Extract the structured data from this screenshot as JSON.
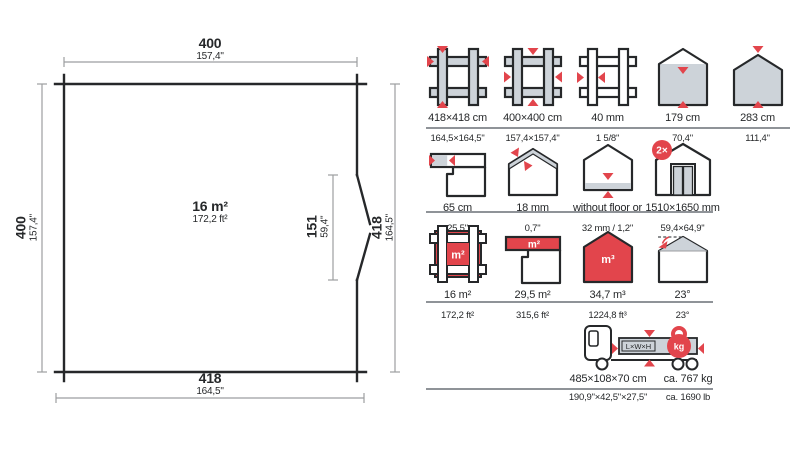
{
  "colors": {
    "accent_red": "#e2454c",
    "icon_gray": "#cdd3d9",
    "outline_black": "#26282a",
    "dimension_gray": "#9c9ea0",
    "divider_gray": "#8f9398"
  },
  "floor_plan": {
    "area": {
      "metric": "16 m²",
      "imperial": "172,2 ft²"
    },
    "dim_top": {
      "metric": "400",
      "imperial": "157,4\""
    },
    "dim_left": {
      "metric": "400",
      "imperial": "157,4\""
    },
    "dim_bottom": {
      "metric": "418",
      "imperial": "164,5\""
    },
    "dim_right": {
      "metric": "418",
      "imperial": "164,5\""
    },
    "dim_door": {
      "metric": "151",
      "imperial": "59,4\""
    }
  },
  "specs": {
    "row1": [
      {
        "icon": "corner-joint-outer-dims-icon",
        "metric": "418×418 cm",
        "imperial": "164,5×164,5\""
      },
      {
        "icon": "corner-joint-inner-dims-icon",
        "metric": "400×400 cm",
        "imperial": "157,4×157,4\""
      },
      {
        "icon": "wall-thickness-icon",
        "metric": "40 mm",
        "imperial": "1 5/8\""
      },
      {
        "icon": "wall-height-icon",
        "metric": "179 cm",
        "imperial": "70,4\""
      },
      {
        "icon": "ridge-height-icon",
        "metric": "283 cm",
        "imperial": "111,4\""
      }
    ],
    "row2": [
      {
        "icon": "roof-overhang-icon",
        "metric": "65 cm",
        "imperial": "25,5\""
      },
      {
        "icon": "roof-board-thickness-icon",
        "metric": "18 mm",
        "imperial": "0,7\""
      },
      {
        "icon": "floor-board-icon",
        "metric": "without floor or",
        "imperial": "32 mm / 1,2\""
      },
      {
        "icon": "double-door-icon",
        "badge": "2×",
        "metric": "1510×1650 mm",
        "imperial": "59,4×64,9\""
      }
    ],
    "row3": [
      {
        "icon": "floor-area-icon",
        "overlay": "m²",
        "metric": "16 m²",
        "imperial": "172,2 ft²"
      },
      {
        "icon": "roof-area-icon",
        "overlay": "m²",
        "metric": "29,5 m²",
        "imperial": "315,6 ft²"
      },
      {
        "icon": "volume-icon",
        "overlay": "m³",
        "metric": "34,7 m³",
        "imperial": "1224,8 ft³"
      },
      {
        "icon": "roof-pitch-icon",
        "metric": "23°",
        "imperial": "23°"
      }
    ],
    "shipping": {
      "icon": "truck-icon",
      "load_label": "L×W×H",
      "kg_label": "kg",
      "dims": {
        "metric": "485×108×70 cm",
        "imperial": "190,9\"×42,5\"×27,5\""
      },
      "weight": {
        "metric": "ca. 767 kg",
        "imperial": "ca. 1690 lb"
      }
    }
  }
}
